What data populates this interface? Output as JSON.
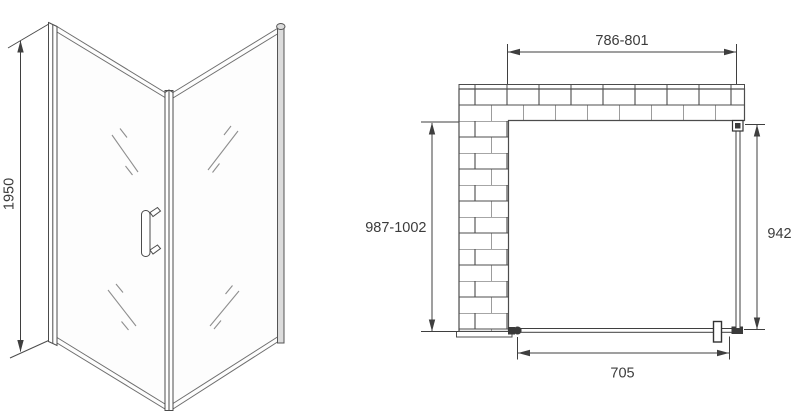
{
  "figure": {
    "background_color": "#ffffff",
    "line_color": "#4c4c4c",
    "dimension_color": "#3f3f3f",
    "text_color": "#3c3c3c"
  },
  "perspective_view": {
    "height_dimension": "1950"
  },
  "plan_view": {
    "top_width_dimension": "786-801",
    "left_depth_dimension": "987-1002",
    "right_panel_dimension": "942",
    "door_width_dimension": "705"
  }
}
